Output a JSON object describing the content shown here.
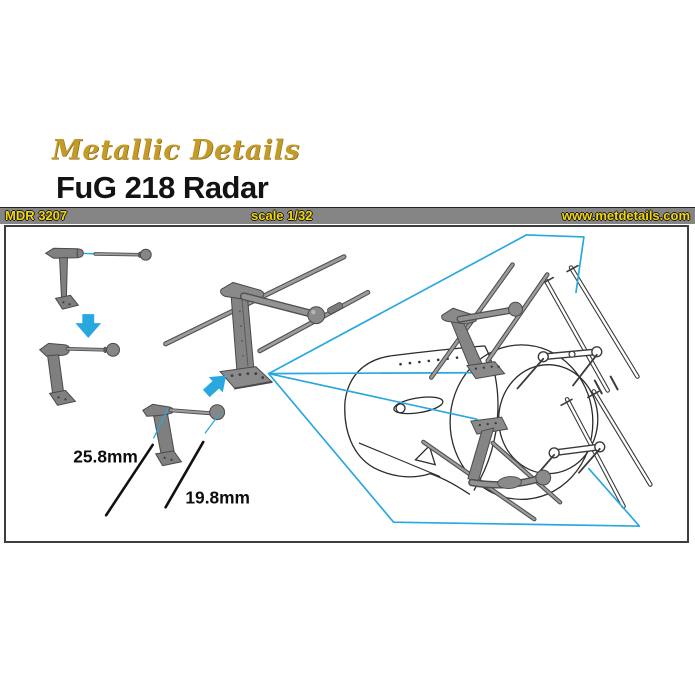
{
  "header": {
    "brand": "Metallic Details",
    "title": "FuG 218 Radar"
  },
  "infobar": {
    "product_code": "MDR 3207",
    "scale": "scale 1/32",
    "website": "www.metdetails.com"
  },
  "diagram": {
    "measurements": [
      {
        "label": "25.8mm"
      },
      {
        "label": "19.8mm"
      }
    ],
    "icons": [
      "arrow-down-icon",
      "arrow-up-right-icon"
    ],
    "colors": {
      "callout_cyan": "#29A8E0",
      "part_gray": "#8A8A8A",
      "bar_background": "#858585",
      "bar_text": "#F3D60B",
      "logo_gold": "#C59B28"
    }
  }
}
